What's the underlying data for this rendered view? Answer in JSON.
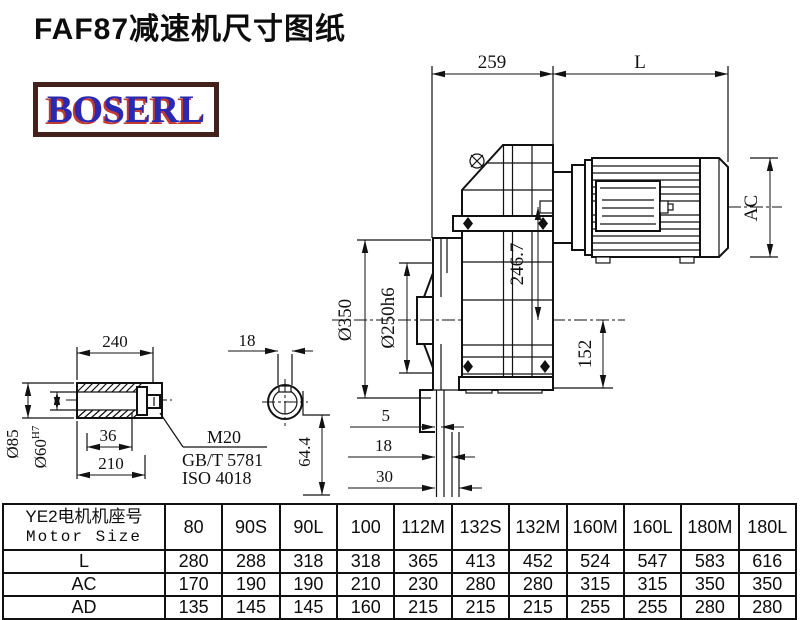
{
  "page": {
    "title": "FAF87减速机尺寸图纸",
    "logo": "BOSERL"
  },
  "drawing": {
    "dims": {
      "reducer_length": "259",
      "motor_length": "L",
      "motor_diameter": "AC",
      "axis_height": "246.7",
      "flange_od": "Ø350",
      "spigot_dia": "Ø250h6",
      "foot_height": "152",
      "offset_small": "5",
      "offset_mid": "18",
      "offset_large": "30",
      "depth": "64.4"
    },
    "shaft_detail": {
      "length": "240",
      "key_width": "18",
      "shaft_od": "Ø85",
      "bore_dia": "Ø60",
      "bore_tol": "H7",
      "bolt_depth": "36",
      "usable_length": "210",
      "bolt": "M20",
      "std1": "GB/T 5781",
      "std2": "ISO 4018"
    }
  },
  "table": {
    "header": {
      "line1": "YE2电机机座号",
      "line2": "Motor Size"
    },
    "columns": [
      "80",
      "90S",
      "90L",
      "100",
      "112M",
      "132S",
      "132M",
      "160M",
      "160L",
      "180M",
      "180L"
    ],
    "rows": [
      {
        "label": "L",
        "values": [
          "280",
          "288",
          "318",
          "318",
          "365",
          "413",
          "452",
          "524",
          "547",
          "583",
          "616"
        ]
      },
      {
        "label": "AC",
        "values": [
          "170",
          "190",
          "190",
          "210",
          "230",
          "280",
          "280",
          "315",
          "315",
          "350",
          "350"
        ]
      },
      {
        "label": "AD",
        "values": [
          "135",
          "145",
          "145",
          "160",
          "215",
          "215",
          "215",
          "255",
          "255",
          "280",
          "280"
        ]
      }
    ]
  },
  "colors": {
    "line": "#111111",
    "logo_blue": "#2929b4",
    "logo_red": "#c23a30",
    "logo_frame": "#43211d"
  }
}
